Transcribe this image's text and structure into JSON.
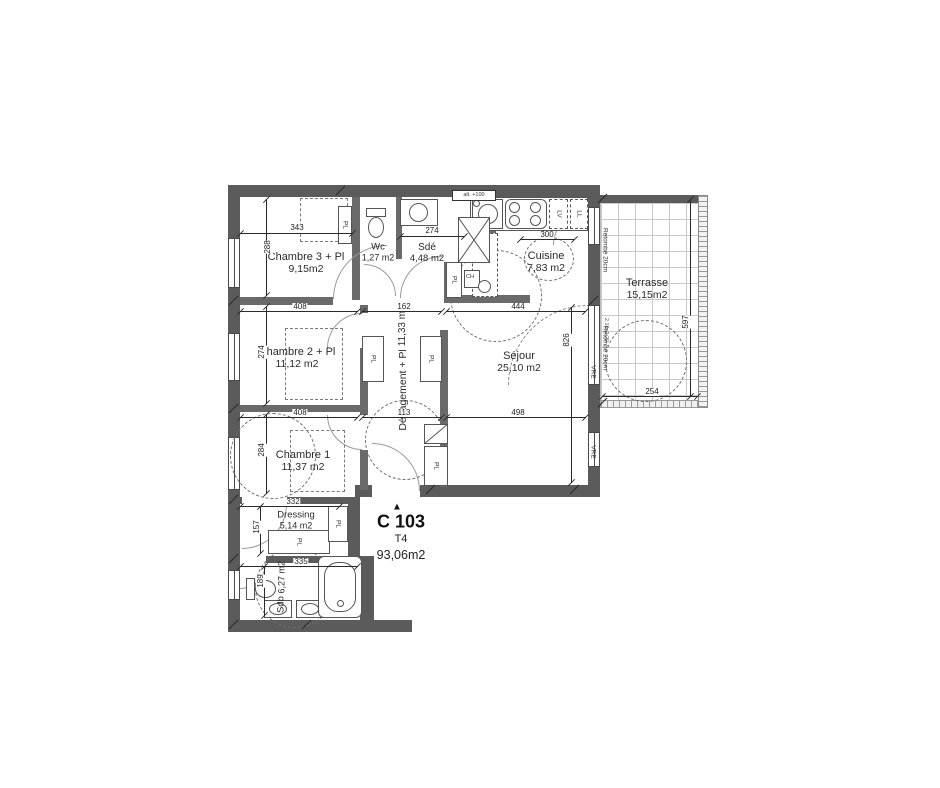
{
  "colors": {
    "wall": "#5b5b5b",
    "line": "#4a4a4a",
    "dashed": "#6e6e6e",
    "text": "#2b2b2b",
    "terrace_grid": "#c9c9c9"
  },
  "unit": {
    "marker": "▲",
    "code": "C 103",
    "type": "T4",
    "area": "93,06m2"
  },
  "rooms": [
    {
      "id": "chambre3",
      "name": "Chambre 3 + Pl",
      "area": "9,15m2"
    },
    {
      "id": "wc",
      "name": "Wc",
      "area": "1,27 m2"
    },
    {
      "id": "sde",
      "name": "Sdé",
      "area": "4,48 m2"
    },
    {
      "id": "cuisine",
      "name": "Cuisine",
      "area": "7,83 m2"
    },
    {
      "id": "terrasse",
      "name": "Terrasse",
      "area": "15,15m2"
    },
    {
      "id": "sejour",
      "name": "Séjour",
      "area": "25,10 m2"
    },
    {
      "id": "degagement",
      "name": "Dégagement + Pl",
      "area": "11,33 m2"
    },
    {
      "id": "chambre2",
      "name": "Chambre 2 + Pl",
      "area": "11,12 m2"
    },
    {
      "id": "chambre1",
      "name": "Chambre 1",
      "area": "11,37 m2"
    },
    {
      "id": "dressing",
      "name": "Dressing",
      "area": "5,14 m2"
    },
    {
      "id": "sdb",
      "name": "Sdb",
      "area": "6,27 m2"
    }
  ],
  "labels": {
    "pl": "PL",
    "ch": "CH",
    "lv": "LV",
    "ll": "LL"
  },
  "annotations": {
    "alt": "alt. +100",
    "window_size": "2.10x2.20",
    "vre": "VRE",
    "retombe": "Retombé 20cm"
  },
  "dimensions": [
    {
      "text": "343"
    },
    {
      "text": "288"
    },
    {
      "text": "274"
    },
    {
      "text": "300"
    },
    {
      "text": "408"
    },
    {
      "text": "274"
    },
    {
      "text": "162"
    },
    {
      "text": "444"
    },
    {
      "text": "826"
    },
    {
      "text": "408"
    },
    {
      "text": "284"
    },
    {
      "text": "113"
    },
    {
      "text": "498"
    },
    {
      "text": "332"
    },
    {
      "text": "157"
    },
    {
      "text": "335"
    },
    {
      "text": "189"
    },
    {
      "text": "597"
    },
    {
      "text": "254"
    }
  ]
}
